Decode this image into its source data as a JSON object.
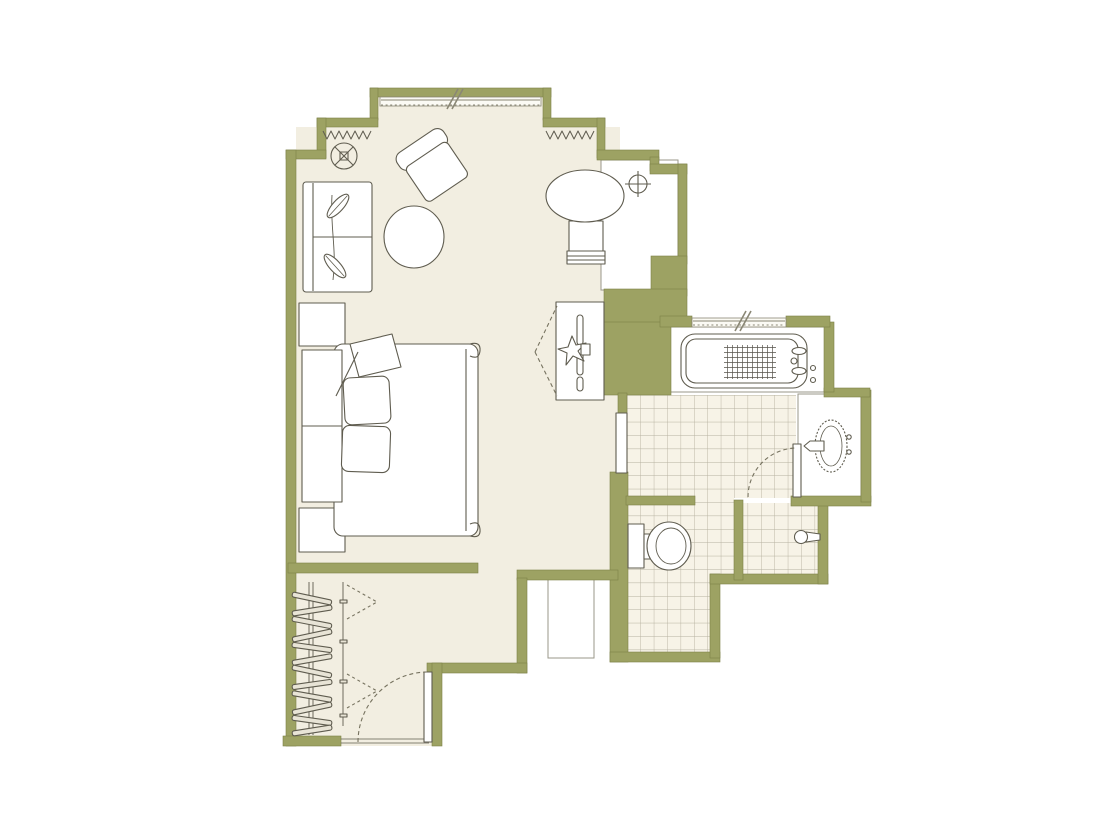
{
  "palette": {
    "wall": "#9da263",
    "floor": "#f2eee1",
    "bath_floor": "#f7f3e7",
    "tile_line": "#a5a08d",
    "white": "#ffffff",
    "outline": "#5f5c4f",
    "dash": "#76725f",
    "window_line": "#8a8775",
    "background": "#ffffff"
  },
  "plan": {
    "rooms": [
      {
        "name": "bay-window-nook"
      },
      {
        "name": "bedroom-living-area"
      },
      {
        "name": "entry-hall-closet"
      },
      {
        "name": "bathroom"
      },
      {
        "name": "toilet-room"
      },
      {
        "name": "shower"
      },
      {
        "name": "vanity-nook"
      }
    ],
    "fixtures": [
      "sofa",
      "armchair",
      "ottoman",
      "side-table",
      "tv-console",
      "bed",
      "nightstand",
      "bathtub",
      "sink",
      "toilet",
      "shower-head",
      "closet-hangers",
      "entry-door",
      "bathroom-door",
      "ceiling-light",
      "ceiling-fan",
      "curtains",
      "window"
    ]
  }
}
